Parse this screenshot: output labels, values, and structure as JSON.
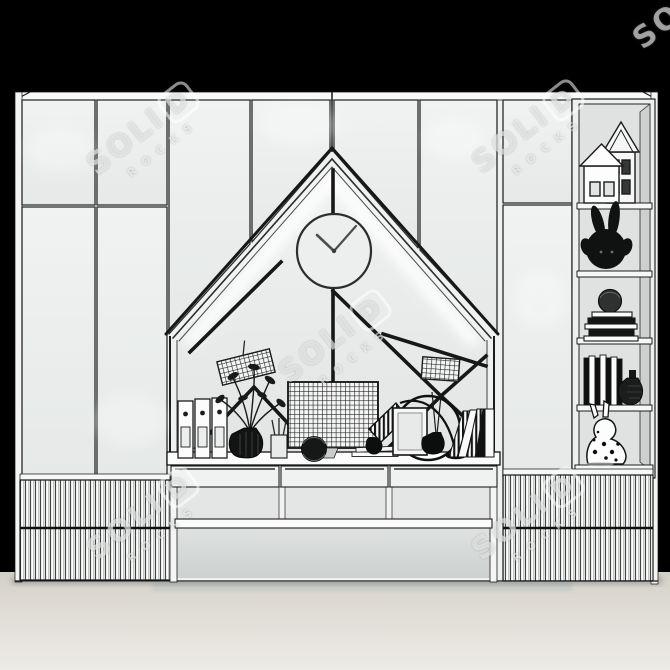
{
  "watermark": {
    "brand_prefix": "SOLI",
    "brand_last": "D",
    "sub": "ROCKS",
    "color": "#ffffff"
  },
  "clock": {
    "approx_time_shown": "10:09"
  },
  "palette": {
    "background": "#000000",
    "cabinet_panel": "#eef0ef",
    "outline": "#1d1f1e",
    "floor": "#e3e0d8",
    "under_desk_shadow": "#c7cac8",
    "led_glow": "#ffffff",
    "dark_decor": "#141414"
  },
  "furniture": {
    "left_wardrobe": {
      "door_columns": 3,
      "fluted_drawer_rows": 2
    },
    "center_section": {
      "niche_shape": "house-gable",
      "has_wall_clock": true,
      "desk_drawers": 3,
      "open_shelf_rows": 2
    },
    "right_wardrobe": {
      "door_columns": 1,
      "fluted_drawer_rows": 2
    },
    "shelf_column_items": [
      "house-figurines",
      "bunny-plush",
      "book-stack-with-sphere",
      "books-row-and-vase",
      "polka-dot-rabbit-figurine"
    ],
    "desk_items": [
      "ring-binders",
      "plant-in-ribbed-vase",
      "pencil-cup",
      "grid-memo-board",
      "mesh-sphere-basket",
      "paper-stack",
      "striped-cone-desk-lamp",
      "photo-frame",
      "round-hoop",
      "bud-vase-with-stems",
      "leaning-striped-books"
    ]
  }
}
